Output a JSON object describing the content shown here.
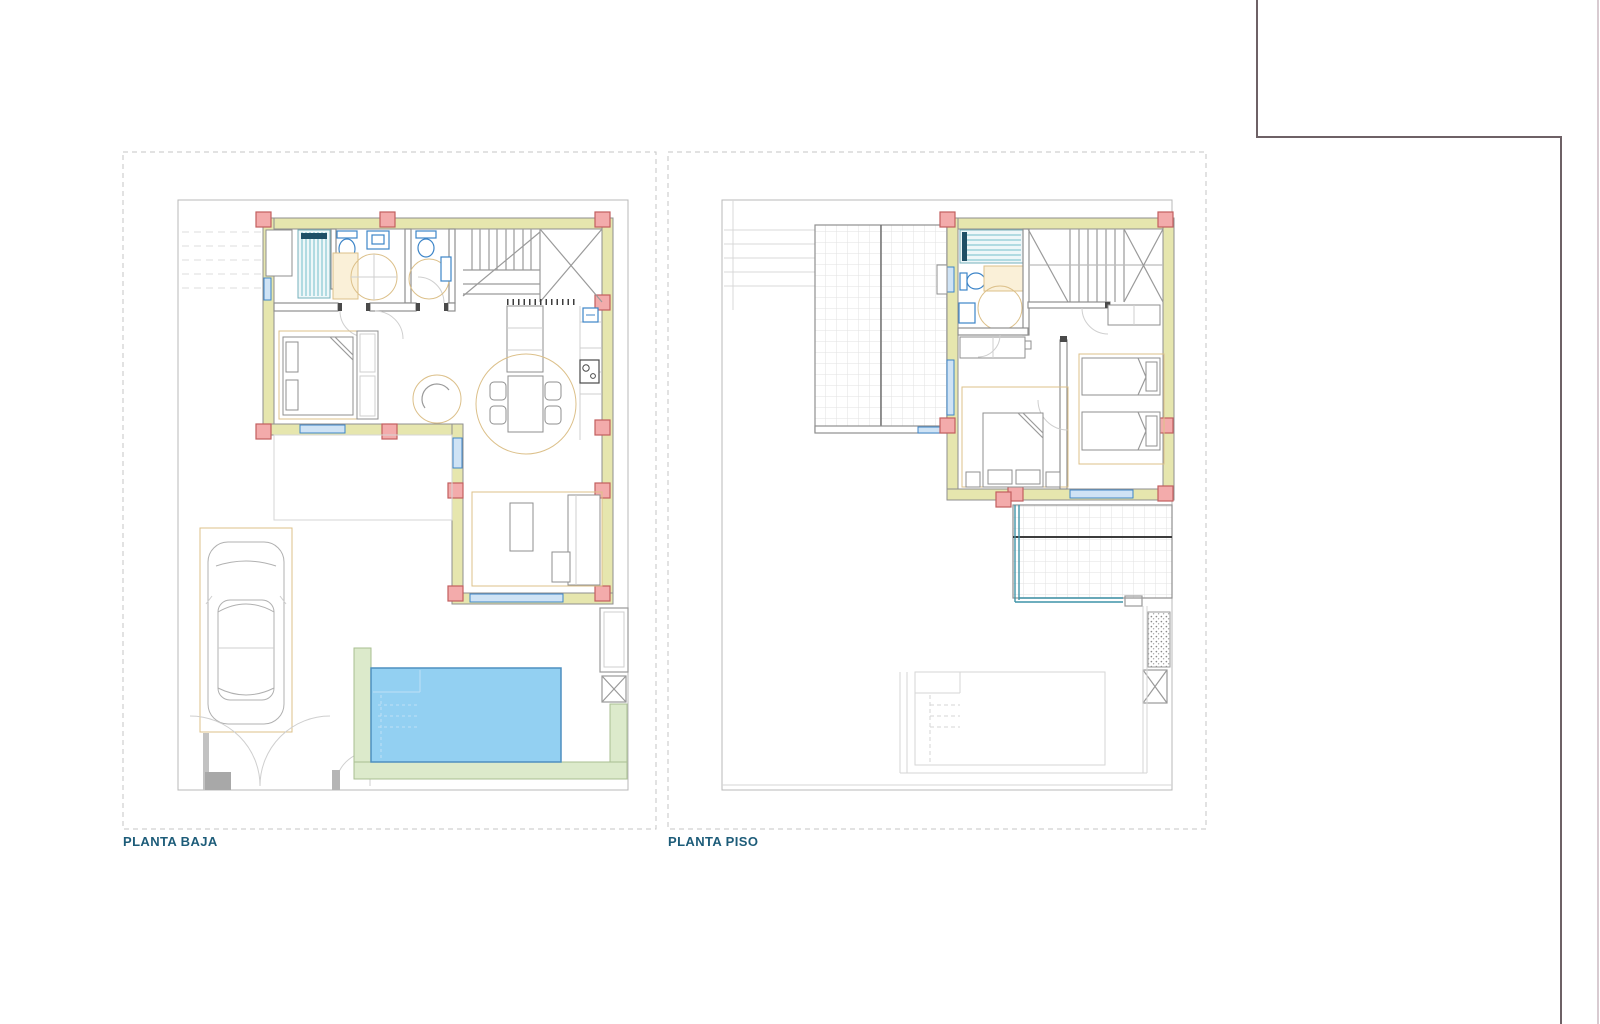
{
  "document": {
    "type": "architectural-floor-plan-sheet",
    "plans": [
      {
        "id": "planta-baja",
        "label": "PLANTA BAJA"
      },
      {
        "id": "planta-piso",
        "label": "PLANTA PISO"
      }
    ]
  },
  "palette": {
    "bg": "#ffffff",
    "panelDash": "#c6c6c6",
    "lot": "#b8b8b8",
    "wallLine": "#8f8f8f",
    "wallFill": "#e6e6ae",
    "colFill": "#f3abab",
    "colLine": "#c25f5f",
    "blue": "#3d85c8",
    "blueLight": "#cfe3f5",
    "teal": "#74bfca",
    "tealDark": "#1e4f66",
    "tan": "#dcc08a",
    "tanLight": "#faf0d8",
    "green": "#dceacb",
    "greenLine": "#a9bf91",
    "poolFill": "#93d0f2",
    "poolLine": "#4e8fc0",
    "poolSteps": "#bfe0f5",
    "ghost": "#d6d6d6",
    "neighbor": "#6e6166",
    "label": "#1d5c79"
  },
  "icons": [
    "pool-icon",
    "car-icon",
    "shower-icon",
    "toilet-icon",
    "sink-icon",
    "bed-icon",
    "stairs-icon",
    "dining-table-icon",
    "hob-icon",
    "column-icon"
  ]
}
